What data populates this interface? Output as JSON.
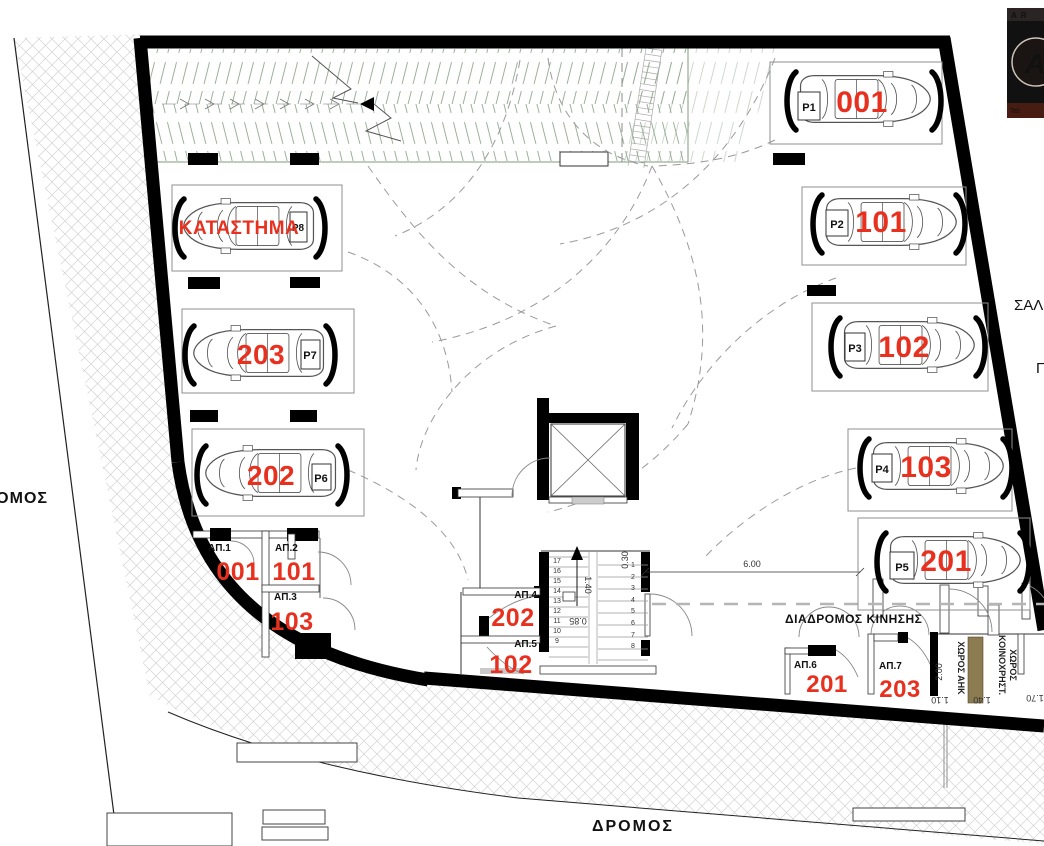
{
  "labels": {
    "road_left": "ΔΡΟΜΟΣ",
    "road_bottom": "ΔΡΟΜΟΣ",
    "street_right": "ΣΑΛ",
    "street_right_2": "Π",
    "corridor": "ΔΙΑΔΡΟΜΟΣ ΚΙΝΗΣΗΣ"
  },
  "parking": [
    {
      "space": "P1",
      "unit": "001"
    },
    {
      "space": "P2",
      "unit": "101"
    },
    {
      "space": "P3",
      "unit": "102"
    },
    {
      "space": "P4",
      "unit": "103"
    },
    {
      "space": "P5",
      "unit": "201"
    },
    {
      "space": "P6",
      "unit": "202"
    },
    {
      "space": "P7",
      "unit": "203"
    },
    {
      "space": "P8",
      "unit": "ΚΑΤΑΣΤΗΜΑ"
    }
  ],
  "storage": [
    {
      "room": "ΑΠ.1",
      "unit": "001"
    },
    {
      "room": "ΑΠ.2",
      "unit": "101"
    },
    {
      "room": "ΑΠ.3",
      "unit": "103"
    },
    {
      "room": "ΑΠ.4",
      "unit": "202"
    },
    {
      "room": "ΑΠ.5",
      "unit": "102"
    },
    {
      "room": "ΑΠ.6",
      "unit": "201"
    },
    {
      "room": "ΑΠ.7",
      "unit": "203"
    }
  ],
  "utility": {
    "ahk": "ΧΩΡΟΣ ΑΗΚ",
    "common_1": "ΚΟΙΝΟΧΡΗΣΤ.",
    "common_2": "ΧΩΡΟΣ"
  },
  "dims": {
    "aisle": "6.00",
    "ahk": "2.00",
    "w110": "1.10",
    "w140": "1.40",
    "w170": "1.70",
    "stair_w": "1.40",
    "tread": "0.85",
    "d030": "0.30"
  },
  "stairs": {
    "right": [
      "1",
      "2",
      "3",
      "4",
      "5",
      "6",
      "7",
      "8"
    ],
    "left": [
      "17",
      "16",
      "15",
      "14",
      "13",
      "12",
      "11",
      "10",
      "9"
    ]
  },
  "logo": {
    "header": "AR",
    "letter": "A",
    "tel": "Tel:"
  },
  "colors": {
    "unit_red": "#e8301f",
    "ramp_green": "#7d9b7d",
    "utility_brown": "#8b7c52"
  }
}
